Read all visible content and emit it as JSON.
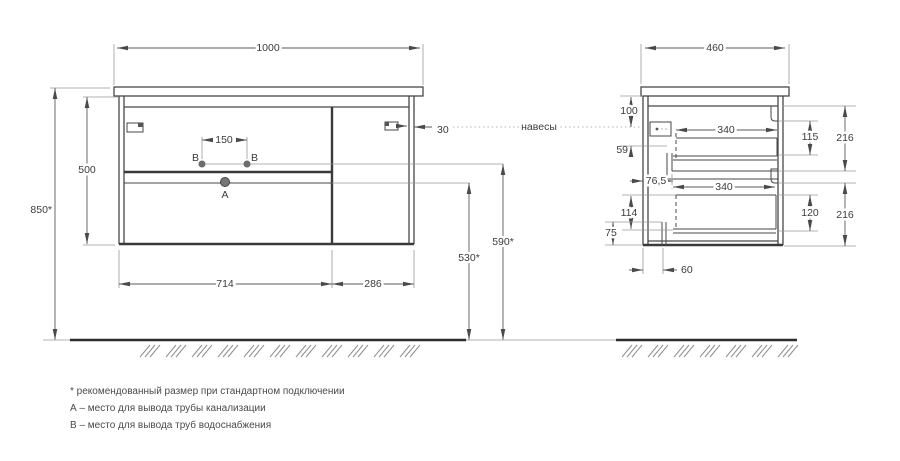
{
  "labels": {
    "hangers": "навесы",
    "point_a": "A",
    "point_b": "B"
  },
  "front_view": {
    "width": "1000",
    "total_height": "850*",
    "body_height": "500",
    "hole_spacing": "150",
    "wall_gap": "30",
    "left_section_width": "714",
    "right_section_width": "286",
    "drain_height": "530*",
    "supply_height": "590*"
  },
  "side_view": {
    "depth": "460",
    "top_offset": "100",
    "hanger_offset": "59",
    "front_inset": "76,5",
    "drawer_depth_top": "340",
    "drawer_depth_bottom": "340",
    "inner_top": "115",
    "front_top": "216",
    "inner_bottom": "120",
    "front_bottom": "216",
    "lower_offset": "114",
    "bottom_offset": "75",
    "back_inset": "60"
  },
  "notes": {
    "asterisk": "* рекомендованный размер при стандартном подключении",
    "point_a": "А – место для вывода трубы канализации",
    "point_b": "В – место для вывода труб водоснабжения"
  }
}
